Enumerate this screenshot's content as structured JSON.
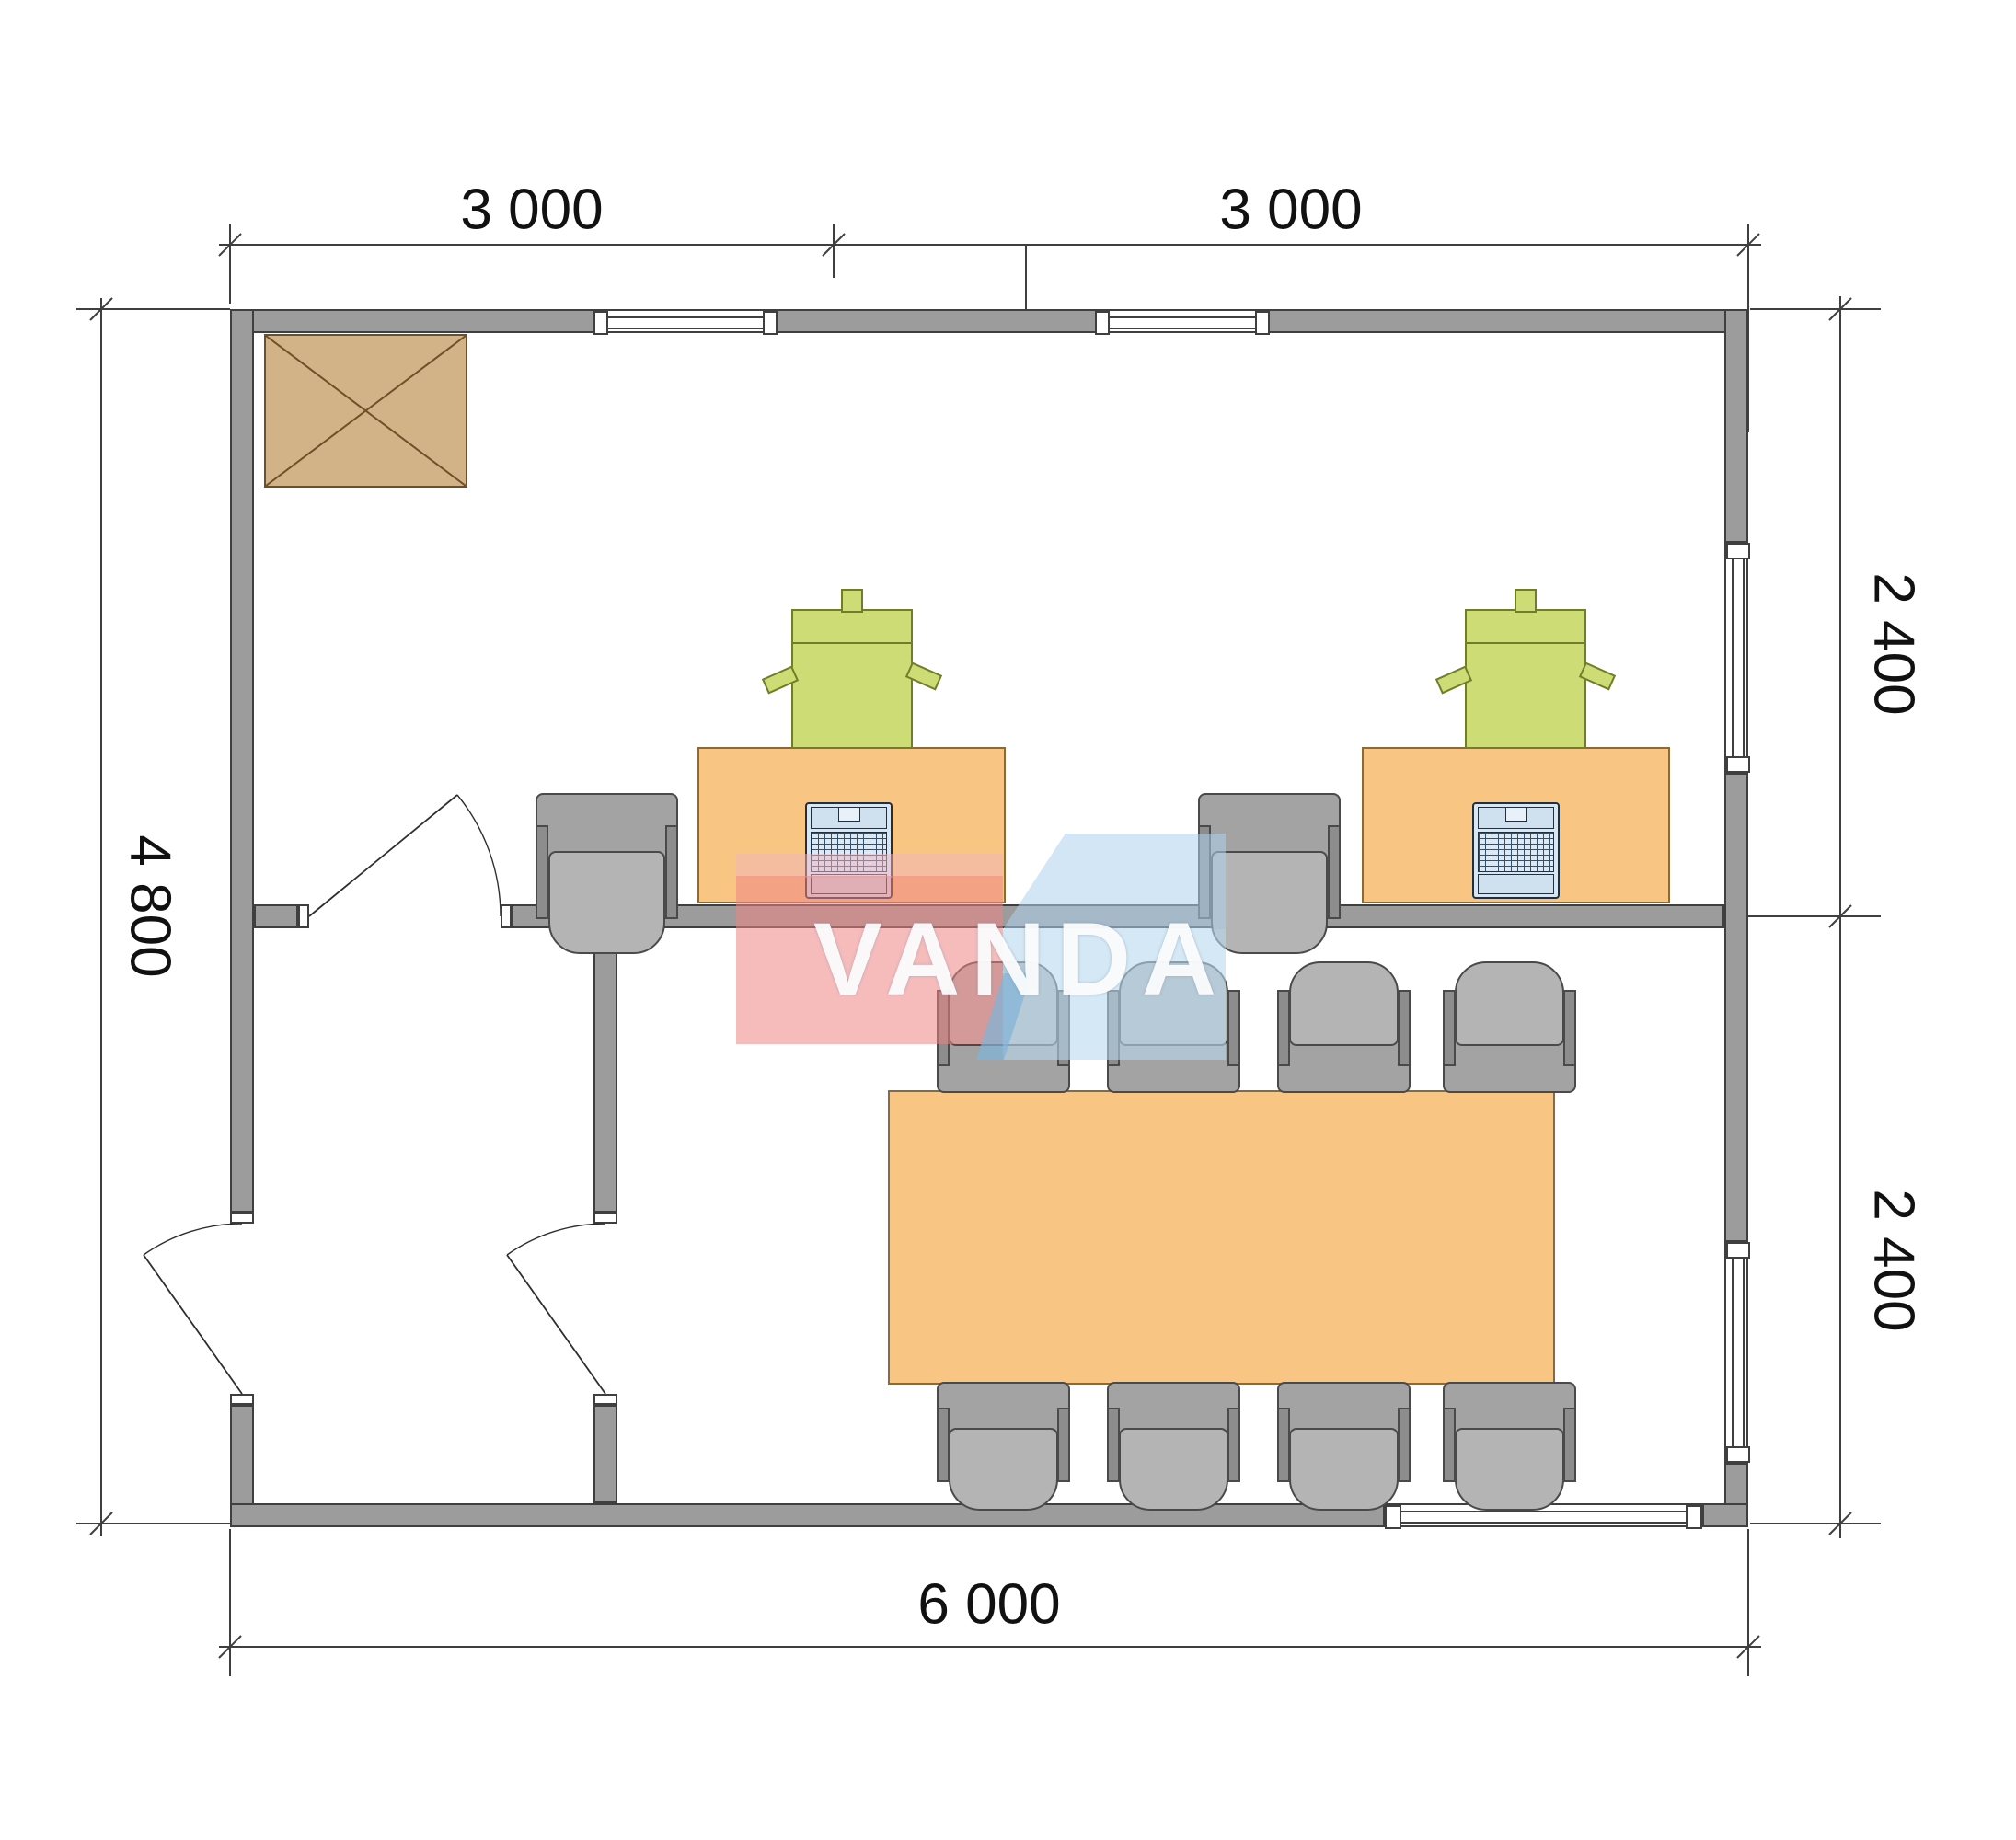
{
  "watermark": {
    "text": "VANDA"
  },
  "dimensions": {
    "top": [
      {
        "label": "3 000"
      },
      {
        "label": "3 000"
      }
    ],
    "right": [
      {
        "label": "2 400"
      },
      {
        "label": "2 400"
      }
    ],
    "left": [
      {
        "label": "4 800"
      }
    ],
    "bottom": [
      {
        "label": "6 000"
      }
    ]
  },
  "inventory": {
    "office_desks": 2,
    "printers": 2,
    "laptops": 2,
    "office_chairs": 2,
    "meeting_table": 1,
    "meeting_chairs": 8,
    "doors": 3,
    "windows": 5,
    "stove_box": 1
  },
  "colors": {
    "wall": "#9c9c9c",
    "wall_outline": "#3f3f3f",
    "desk": "#f9c583",
    "desk_outline": "#8a6a3c",
    "printer": "#cddc74",
    "printer_outline": "#707d2a",
    "chair": "#a8a8a8",
    "chair_outline": "#4a4a4a",
    "laptop": "#d7e6f4",
    "stove": "#d2b388",
    "stove_outline": "#6e4f28",
    "dim_line": "#3f3f3f",
    "dim_text": "#111111",
    "logo_red": "#ee8585",
    "logo_pink": "#f2b6bd",
    "logo_blue": "#b9d8ee",
    "logo_blue_dark": "#7fb3d8"
  }
}
